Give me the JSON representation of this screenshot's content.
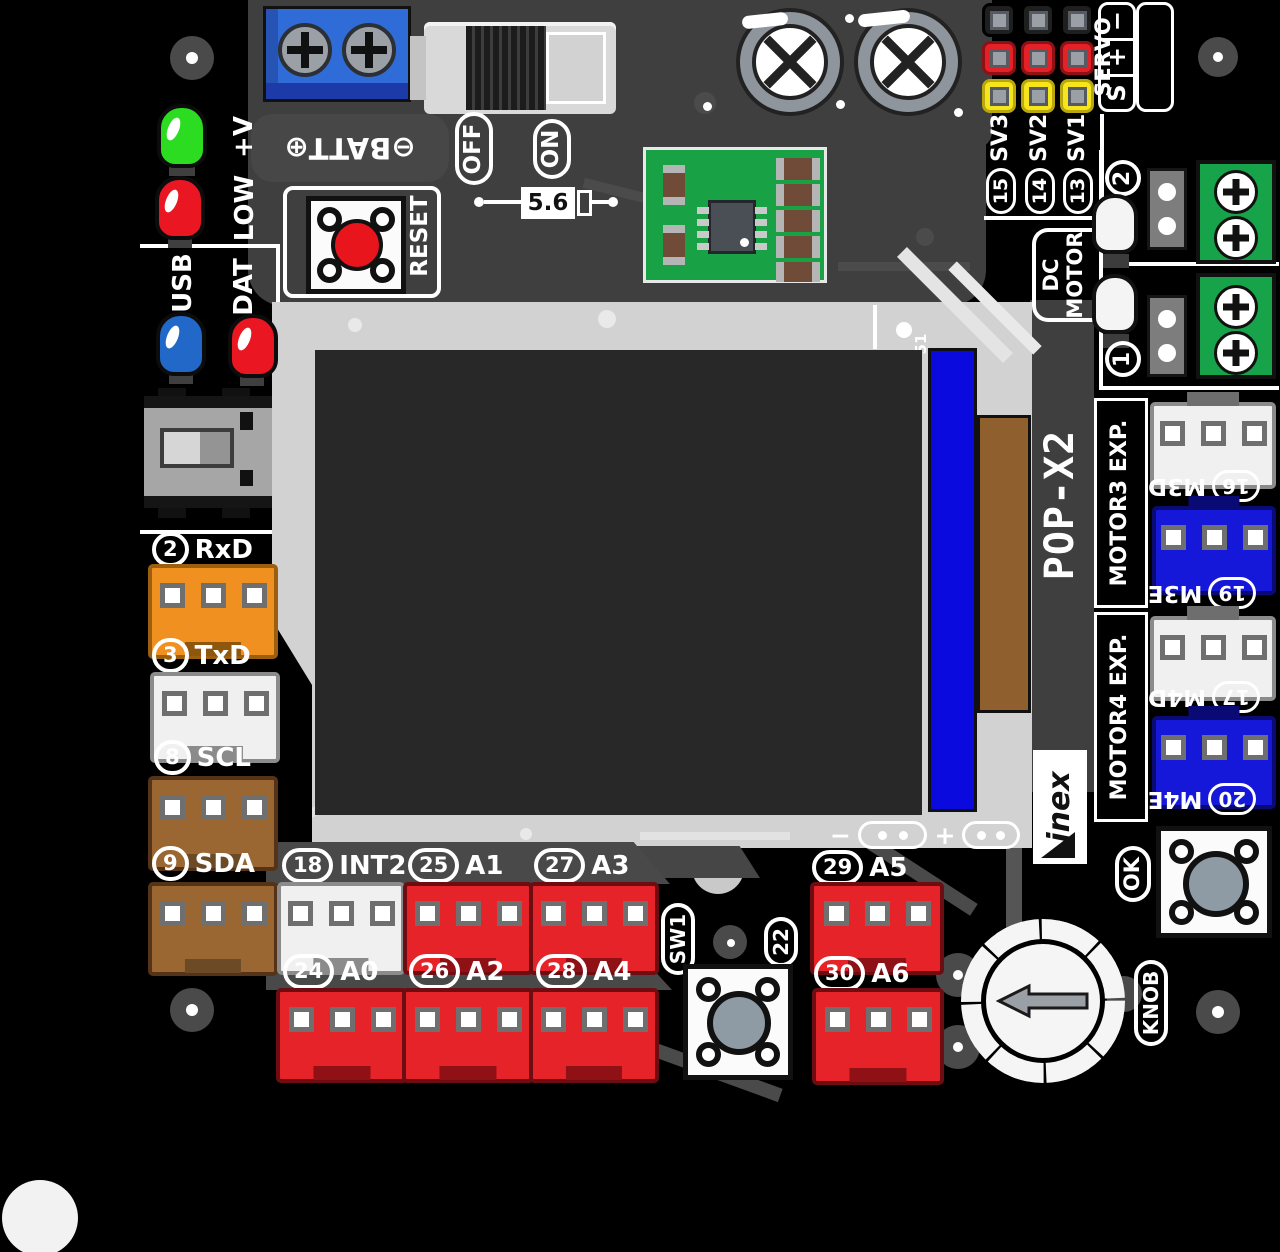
{
  "board": {
    "model": "POP-X2",
    "brand": "inex",
    "ref": "51"
  },
  "power": {
    "batt": "⊖BATT⊕",
    "off": "OFF",
    "on": "ON",
    "reset": "RESET",
    "fuse": "5.6",
    "led_plus_v": "+V",
    "led_low": "LOW"
  },
  "comm": {
    "usb": "USB",
    "dat": "DAT"
  },
  "servo": {
    "title": "SERVO",
    "pin_s": "S",
    "pin_plus": "+",
    "pin_minus": "−",
    "channels": [
      {
        "num": "15",
        "name": "SV3"
      },
      {
        "num": "14",
        "name": "SV2"
      },
      {
        "num": "13",
        "name": "SV1"
      }
    ]
  },
  "dc_motor": {
    "line1": "DC",
    "line2": "MOTOR",
    "ch_top": "2",
    "ch_bottom": "1"
  },
  "motor_exp": {
    "m3_title": "MOTOR3 EXP.",
    "m4_title": "MOTOR4 EXP.",
    "ports": [
      {
        "num": "16",
        "name": "M3D"
      },
      {
        "num": "19",
        "name": "M3E"
      },
      {
        "num": "17",
        "name": "M4D"
      },
      {
        "num": "20",
        "name": "M4E"
      }
    ]
  },
  "left_ports": [
    {
      "num": "2",
      "name": "RxD"
    },
    {
      "num": "3",
      "name": "TxD"
    },
    {
      "num": "8",
      "name": "SCL"
    },
    {
      "num": "9",
      "name": "SDA"
    }
  ],
  "analog": {
    "row1": [
      {
        "num": "18",
        "name": "INT2"
      },
      {
        "num": "25",
        "name": "A1"
      },
      {
        "num": "27",
        "name": "A3"
      }
    ],
    "row2": [
      {
        "num": "24",
        "name": "A0"
      },
      {
        "num": "26",
        "name": "A2"
      },
      {
        "num": "28",
        "name": "A4"
      }
    ],
    "right": [
      {
        "num": "29",
        "name": "A5"
      },
      {
        "num": "30",
        "name": "A6"
      }
    ]
  },
  "controls": {
    "sw1": "SW1",
    "sw1_pin": "22",
    "ok": "OK",
    "knob": "KNOB"
  },
  "lcd": {
    "minus": "−",
    "plus": "+"
  },
  "colors": {
    "accent_red": "#e52329",
    "accent_orange": "#f09021",
    "accent_brown": "#9a6733",
    "accent_blue": "#1518d8",
    "green_terminal": "#17a34a",
    "silk": "#d2d2d2",
    "dark": "#3f3f3f",
    "board": "#000000"
  }
}
